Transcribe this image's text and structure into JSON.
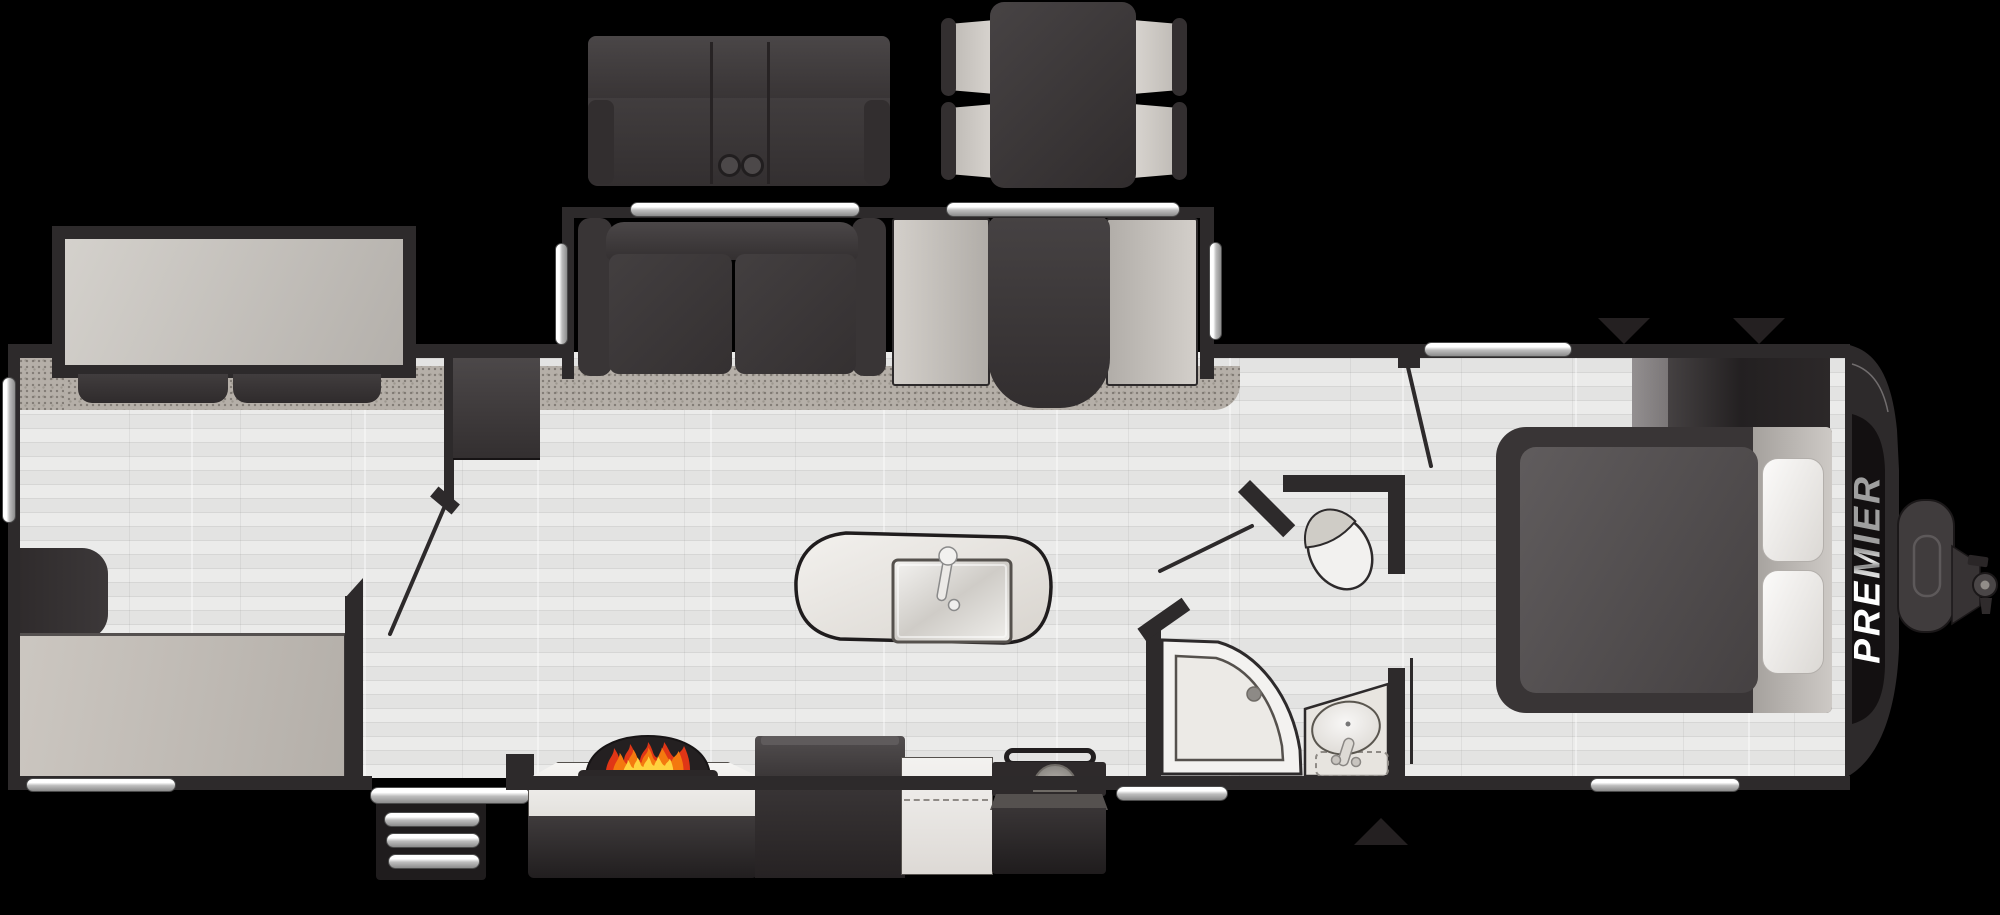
{
  "floorplan": {
    "brand_label": "PREMIER",
    "colors": {
      "background": "#000000",
      "walls": "#2d2a2b",
      "dark_furniture": "#3a3637",
      "wood_floor": "#e6e6e5",
      "carpet": "#b5afa8",
      "light_counter": "#efece8",
      "bench_upholstery": "#c9c5c0",
      "chrome_window": "#d9d9d9",
      "brand_strip": "#131011",
      "flame_red": "#e03616",
      "flame_orange": "#f4790f",
      "flame_yellow": "#ffd23e"
    },
    "markers": {
      "top_markers": [
        "down-triangle",
        "down-triangle"
      ],
      "bottom_markers": [
        "up-triangle"
      ]
    },
    "fixtures": [
      "rear-slide-sofa-bed",
      "rear-flip-bed",
      "refrigerator",
      "tri-fold-sofa-slide",
      "booth-dinette-slide",
      "theater-seating-option",
      "free-standing-dinette-option",
      "kitchen-island-with-sink",
      "fireplace",
      "entertainment-center",
      "range-cooktop",
      "flip-up-counter",
      "entry-steps",
      "corner-shower",
      "toilet",
      "vanity-sink",
      "front-queen-bed",
      "front-wardrobe",
      "a-frame-hitch"
    ]
  }
}
